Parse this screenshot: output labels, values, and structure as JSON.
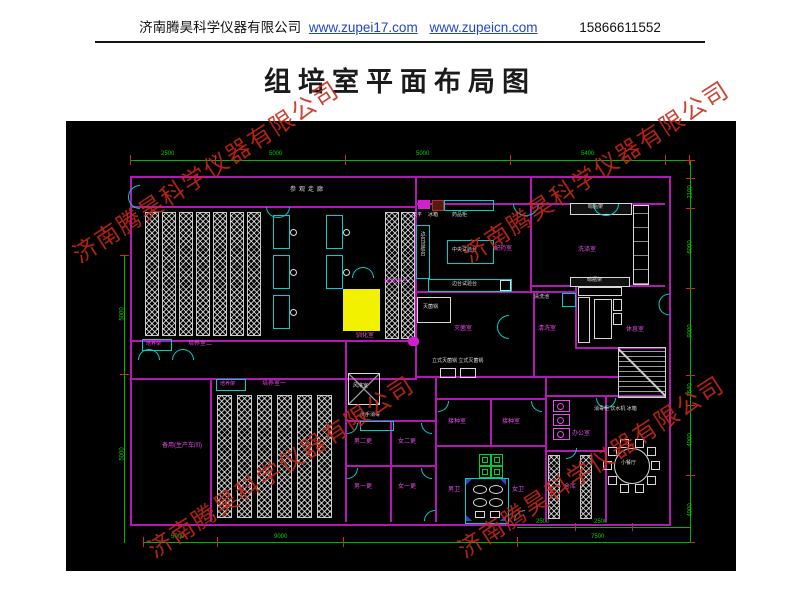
{
  "header": {
    "company": "济南腾昊科学仪器有限公司",
    "link1": "www.zupei17.com",
    "link2": "www.zupeicn.com",
    "phone": "15866611552"
  },
  "title": "组培室平面布局图",
  "watermark": {
    "text": "济南腾昊科学仪器有限公司",
    "color": "#c62817"
  },
  "colors": {
    "wall": "#b517b5",
    "door": "#00cdcd",
    "dimension": "#00b400",
    "tick": "#d22a1a",
    "room_label": "#e44ae4",
    "highlight": "#f2f200",
    "clean_bench": "#00cc33",
    "background": "#000000"
  },
  "plan": {
    "labels": {
      "corridor": "参观走廊",
      "room2": "培养室二",
      "room1": "培养室一",
      "room3": "培养室三",
      "acclim": "驯化室",
      "rack_a": "培养架",
      "rack_b": "培养架",
      "spare": "备用(生产车间)",
      "media": "配药室",
      "wash": "洗涤室",
      "sterile": "灭菌室",
      "rinse": "清洗室",
      "rest": "休息室",
      "inoc_a": "接种室",
      "inoc_b": "接种室",
      "chg_m2": "男二更",
      "chg_f2": "女二更",
      "chg_m1": "男一更",
      "chg_f1": "女一更",
      "airshower": "风淋室",
      "handwash": "洗手消毒",
      "wc_m": "男卫",
      "wc_f": "女卫",
      "office": "办公室",
      "storage": "仓库",
      "dining": "小餐厅",
      "bench_center": "中央试验台",
      "bench_side": "边台试验台",
      "bench_side2": "边台试验台",
      "autoclave": "灭菌锅",
      "autoclaves": "立式灭菌锅 立式灭菌锅",
      "balance": "天平",
      "fridge": "冰箱",
      "cabinet": "药品柜",
      "sink": "清洗池",
      "shelf_a": "晾瓶架",
      "shelf_b": "晾瓶架",
      "appliances": "消毒柜 饮水机 冰箱"
    },
    "dimensions": {
      "top": [
        "2500",
        "5000",
        "5000",
        "5400"
      ],
      "right": [
        "2100",
        "6000",
        "9000",
        "2640",
        "4000",
        "4000"
      ],
      "bottom": [
        "5000",
        "9000",
        "7500"
      ],
      "bottom_upper": [
        "2500",
        "2500"
      ],
      "left": [
        "5000",
        "5000"
      ]
    }
  }
}
